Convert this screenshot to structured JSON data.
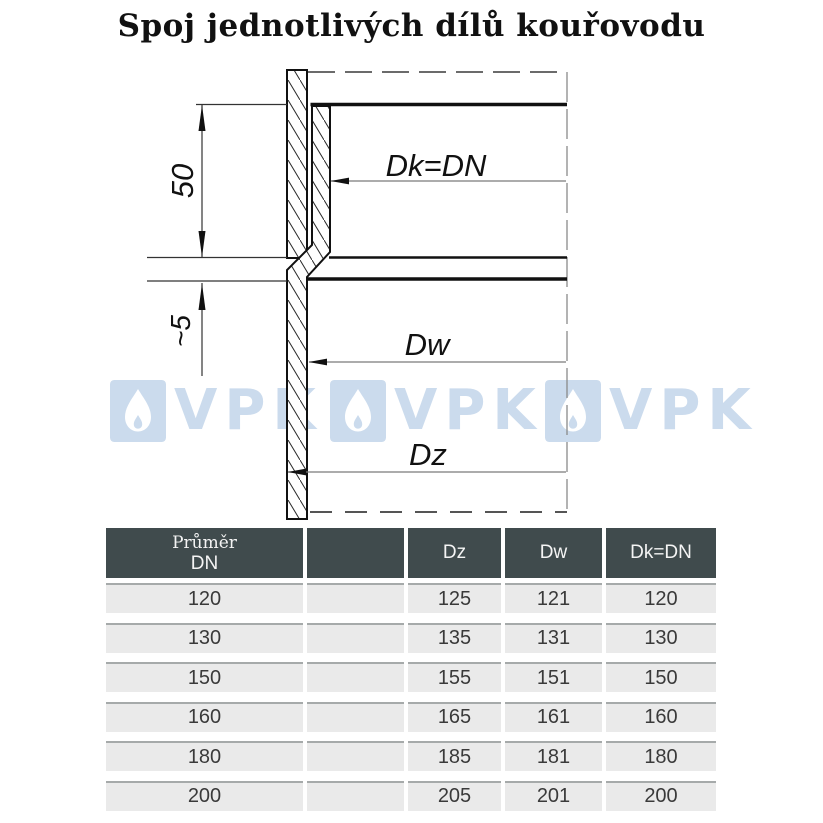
{
  "title": "Spoj jednotlivých dílů kouřovodu",
  "diagram": {
    "labels": {
      "socket_depth": "50",
      "overlap_gap": "~5",
      "inner_top": "Dk=DN",
      "inner_bottom": "Dw",
      "outer": "Dz"
    }
  },
  "watermark": {
    "text": "VPK",
    "color": "#cbdbed"
  },
  "table": {
    "headers": {
      "col1_line1": "Průměr",
      "col1_line2": "DN",
      "col2": "",
      "col3": "Dz",
      "col4": "Dw",
      "col5": "Dk=DN"
    },
    "rows": [
      [
        "120",
        "",
        "125",
        "121",
        "120"
      ],
      [
        "130",
        "",
        "135",
        "131",
        "130"
      ],
      [
        "150",
        "",
        "155",
        "151",
        "150"
      ],
      [
        "160",
        "",
        "165",
        "161",
        "160"
      ],
      [
        "180",
        "",
        "185",
        "181",
        "180"
      ],
      [
        "200",
        "",
        "205",
        "201",
        "200"
      ]
    ]
  },
  "colors": {
    "header_bg": "#404b4d",
    "row_bg": "#eaeaea",
    "watermark_blue": "#cbdbed",
    "line_black": "#111111",
    "dim_gray": "#777777"
  }
}
